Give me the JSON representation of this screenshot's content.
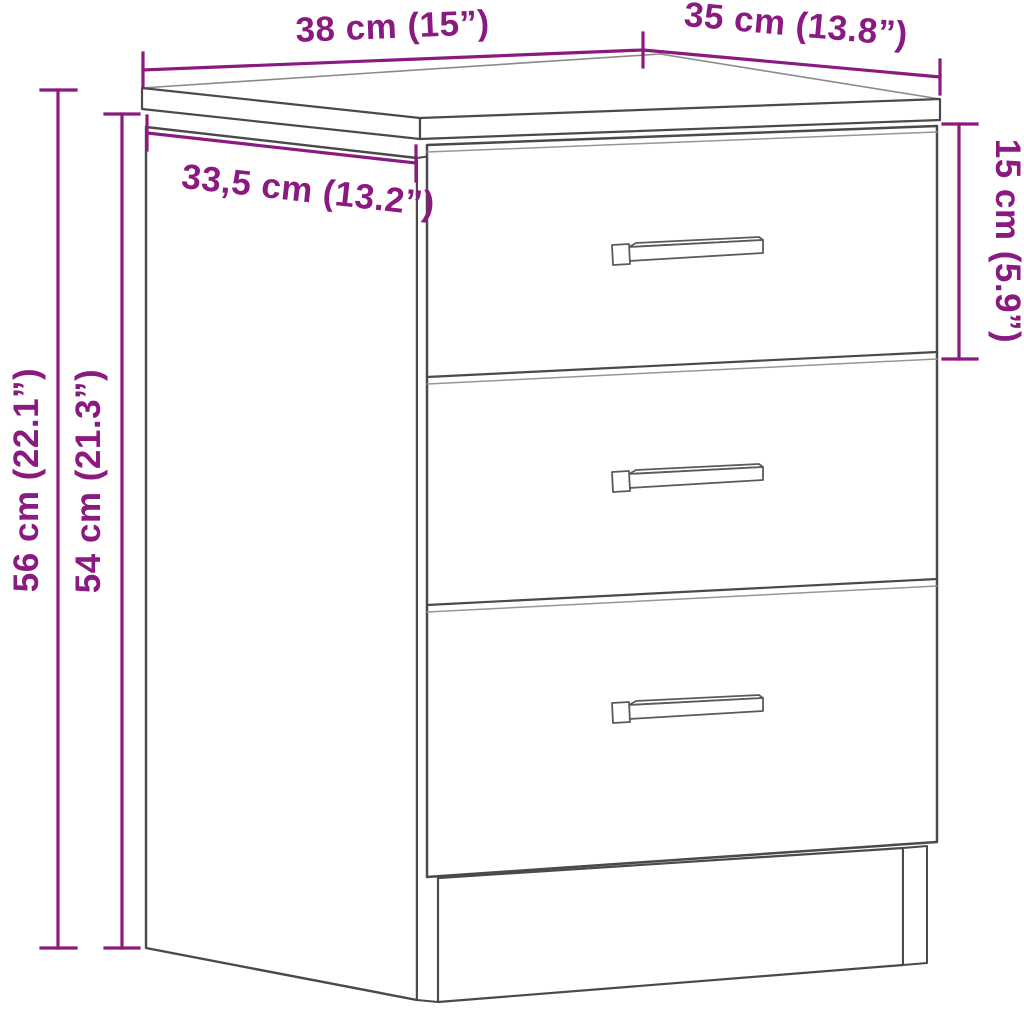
{
  "page": {
    "description": "Line-drawing dimension diagram of a bedside cabinet with three drawers and bar handles",
    "background": "#ffffff"
  },
  "colors": {
    "accent": "#8B1A80",
    "line_dark": "#4a4a4a",
    "line_light": "#969696",
    "fill": "#ffffff"
  },
  "product": {
    "drawers": 3,
    "handles": 3
  },
  "dims": {
    "top_width": {
      "label": "38 cm (15”)",
      "cm": 38,
      "inch": 15
    },
    "top_depth": {
      "label": "35 cm (13.8”)",
      "cm": 35,
      "inch": 13.8
    },
    "side_depth": {
      "label": "33,5 cm (13.2”)",
      "cm": 33.5,
      "inch": 13.2
    },
    "height_total": {
      "label": "56 cm (22.1”)",
      "cm": 56,
      "inch": 22.1
    },
    "height_body": {
      "label": "54 cm (21.3”)",
      "cm": 54,
      "inch": 21.3
    },
    "drawer_height": {
      "label": "15 cm (5.9”)",
      "cm": 15,
      "inch": 5.9
    }
  }
}
